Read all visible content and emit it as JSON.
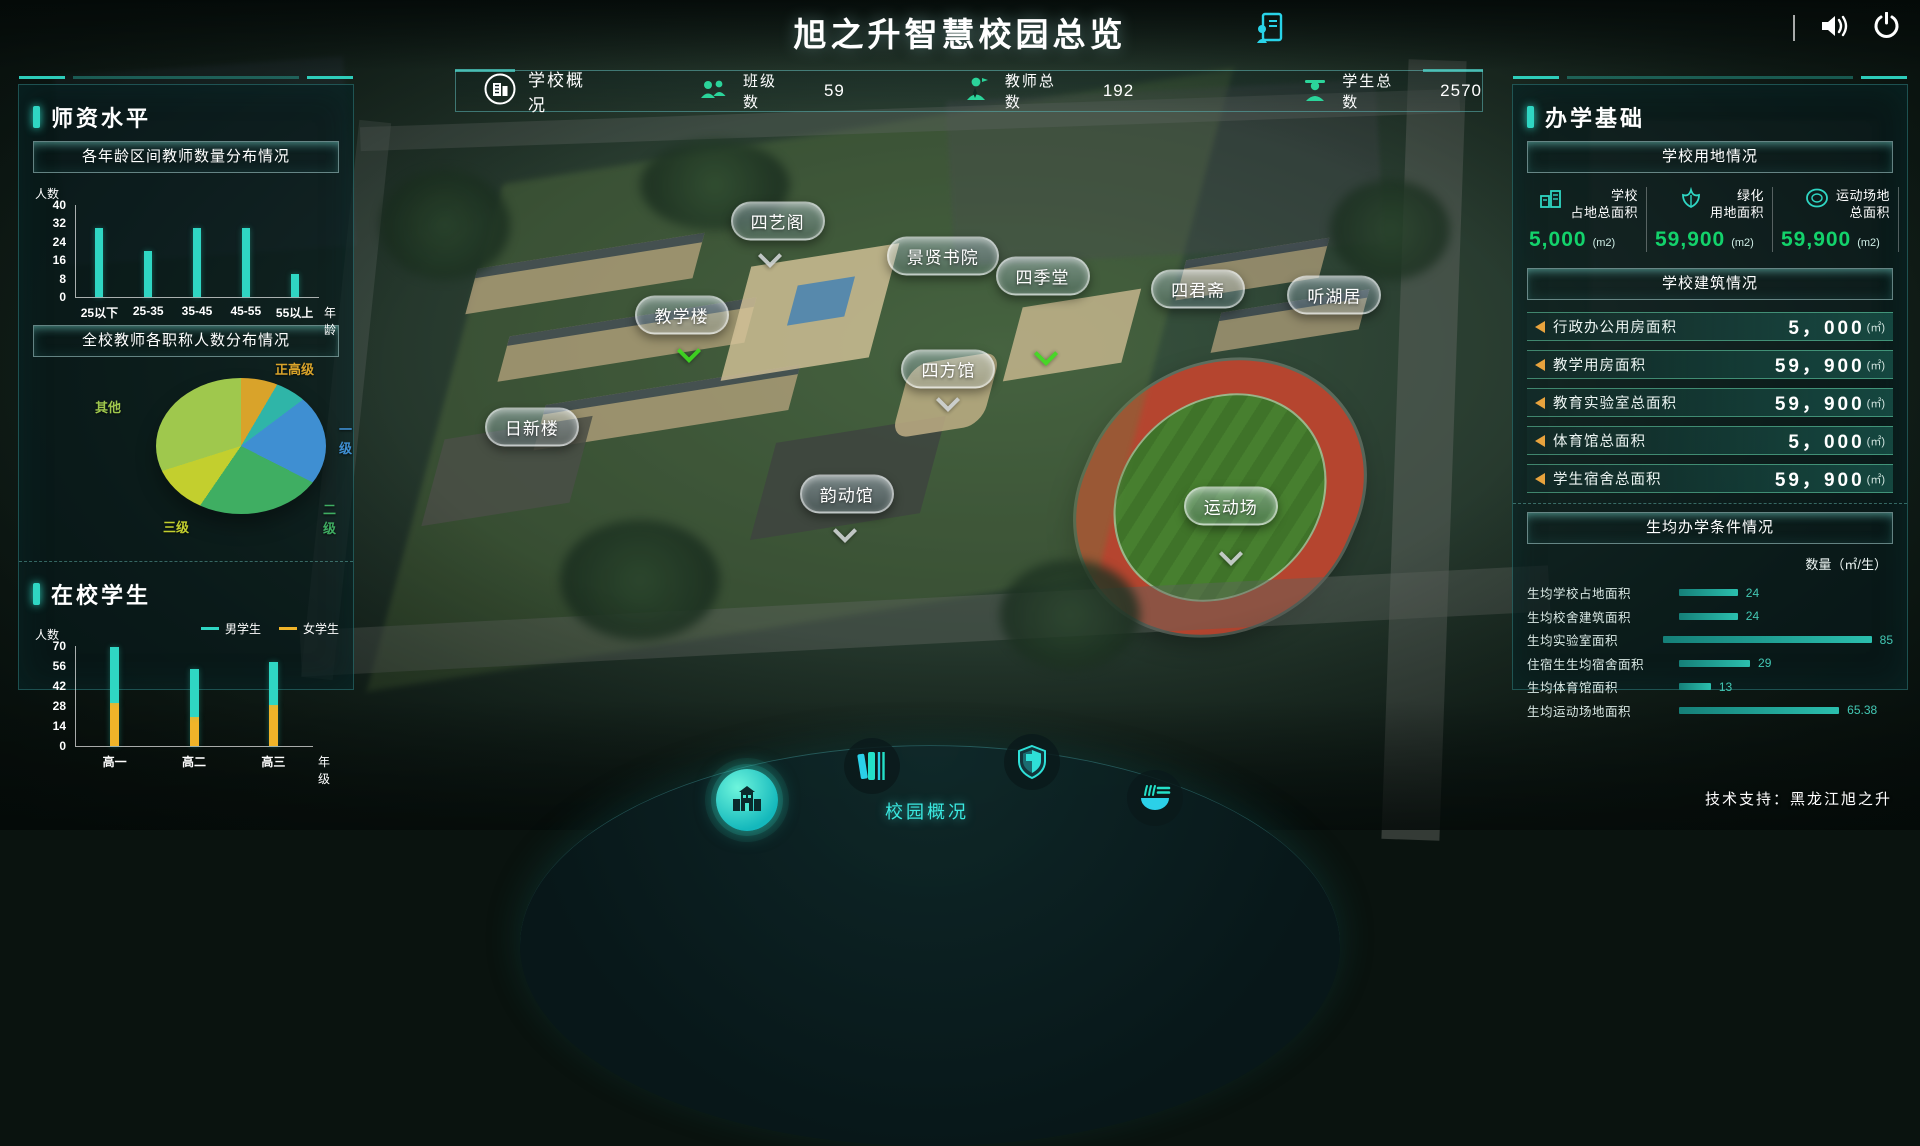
{
  "header": {
    "title": "旭之升智慧校园总览",
    "tech_support": "技术支持：黑龙江旭之升"
  },
  "colors": {
    "accent": "#2fd6c3",
    "value_green": "#13d26b",
    "bar_cyan": "#2fd6c3",
    "bar_yellow": "#f0b429",
    "marker_orange": "#e8a33d"
  },
  "stats_bar": {
    "title": "学校概况",
    "stats": [
      {
        "label": "班级数",
        "value": "59"
      },
      {
        "label": "教师总数",
        "value": "192"
      },
      {
        "label": "学生总数",
        "value": "2570"
      }
    ]
  },
  "left_panel": {
    "section1_title": "师资水平",
    "section2_title": "在校学生"
  },
  "right_panel": {
    "title": "办学基础",
    "land": {
      "title": "学校用地情况",
      "items": [
        {
          "icon": "school-area-icon",
          "label_line1": "学校",
          "label_line2": "占地总面积",
          "value": "5,000",
          "unit": "(m2)"
        },
        {
          "icon": "green-area-icon",
          "label_line1": "绿化",
          "label_line2": "用地面积",
          "value": "59,900",
          "unit": "(m2)"
        },
        {
          "icon": "sports-area-icon",
          "label_line1": "运动场地",
          "label_line2": "总面积",
          "value": "59,900",
          "unit": "(m2)"
        }
      ]
    },
    "buildings": {
      "title": "学校建筑情况",
      "rows": [
        {
          "label": "行政办公用房面积",
          "value": "5，000",
          "unit": "(㎡)"
        },
        {
          "label": "教学用房面积",
          "value": "59，900",
          "unit": "(㎡)"
        },
        {
          "label": "教育实验室总面积",
          "value": "59，900",
          "unit": "(㎡)"
        },
        {
          "label": "体育馆总面积",
          "value": "5，000",
          "unit": "(㎡)"
        },
        {
          "label": "学生宿舍总面积",
          "value": "59，900",
          "unit": "(㎡)"
        }
      ]
    }
  },
  "chart_data": [
    {
      "type": "bar",
      "title": "各年龄区间教师数量分布情况",
      "categories": [
        "25以下",
        "25-35",
        "35-45",
        "45-55",
        "55以上"
      ],
      "values": [
        30,
        20,
        30,
        30,
        10
      ],
      "yticks": [
        0,
        8,
        16,
        24,
        32,
        40
      ],
      "ylabel": "人数",
      "xlabel": "年龄",
      "ylim": [
        0,
        40
      ],
      "color": "#2fd6c3"
    },
    {
      "type": "pie",
      "title": "全校教师各职称人数分布情况",
      "slices": [
        {
          "label": "正高级",
          "value": 7,
          "color": "#d9a32a"
        },
        {
          "label": "",
          "value": 6,
          "color": "#2fb5a8"
        },
        {
          "label": "一级",
          "value": 21,
          "color": "#3f8fd2"
        },
        {
          "label": "二级",
          "value": 24,
          "color": "#3fae62"
        },
        {
          "label": "三级",
          "value": 11,
          "color": "#c3cf2e"
        },
        {
          "label": "其他",
          "value": 31,
          "color": "#9fc84d"
        }
      ]
    },
    {
      "type": "stacked-bar",
      "categories": [
        "高一",
        "高二",
        "高三"
      ],
      "series": [
        {
          "name": "男学生",
          "color": "#2fd6c3",
          "values": [
            39,
            34,
            30
          ]
        },
        {
          "name": "女学生",
          "color": "#f0b429",
          "values": [
            30,
            20,
            29
          ]
        }
      ],
      "yticks": [
        0,
        14,
        28,
        42,
        56,
        70
      ],
      "ylabel": "人数",
      "xlabel": "年级",
      "ylim": [
        0,
        70
      ]
    },
    {
      "type": "hbar",
      "title": "生均办学条件情况",
      "unit_label": "数量（㎡/生）",
      "items": [
        {
          "label": "生均学校占地面积",
          "value": 24
        },
        {
          "label": "生均校舍建筑面积",
          "value": 24
        },
        {
          "label": "生均实验室面积",
          "value": 85
        },
        {
          "label": "住宿生生均宿舍面积",
          "value": 29
        },
        {
          "label": "生均体育馆面积",
          "value": 13
        },
        {
          "label": "生均运动场地面积",
          "value": 65.38
        }
      ],
      "bar_color": "#2bbfae"
    }
  ],
  "map": {
    "labels": [
      {
        "text": "四艺阁",
        "x": 40.5,
        "y": 26.6
      },
      {
        "text": "景贤书院",
        "x": 49.1,
        "y": 30.9
      },
      {
        "text": "四季堂",
        "x": 54.3,
        "y": 33.3
      },
      {
        "text": "四君斋",
        "x": 62.4,
        "y": 34.8
      },
      {
        "text": "听湖居",
        "x": 69.5,
        "y": 35.6
      },
      {
        "text": "教学楼",
        "x": 35.5,
        "y": 37.9
      },
      {
        "text": "四方馆",
        "x": 49.4,
        "y": 44.4
      },
      {
        "text": "日新楼",
        "x": 27.7,
        "y": 51.5
      },
      {
        "text": "韵动馆",
        "x": 44.1,
        "y": 59.5
      },
      {
        "text": "运动场",
        "x": 64.1,
        "y": 61.0
      }
    ],
    "arrows": [
      {
        "type": "gray",
        "x": 40.1,
        "y": 30.8
      },
      {
        "type": "green",
        "x": 35.9,
        "y": 42.3
      },
      {
        "type": "green",
        "x": 54.5,
        "y": 42.6
      },
      {
        "type": "gray",
        "x": 49.4,
        "y": 48.2
      },
      {
        "type": "gray",
        "x": 44.0,
        "y": 64.0
      },
      {
        "type": "gray",
        "x": 64.1,
        "y": 66.8
      }
    ]
  },
  "bottom_nav": {
    "label": "校园概况",
    "icons": [
      "campus-overview-icon",
      "library-icon",
      "security-icon",
      "canteen-icon"
    ]
  },
  "top_icons": [
    "report-icon",
    "sound-icon",
    "power-icon"
  ]
}
